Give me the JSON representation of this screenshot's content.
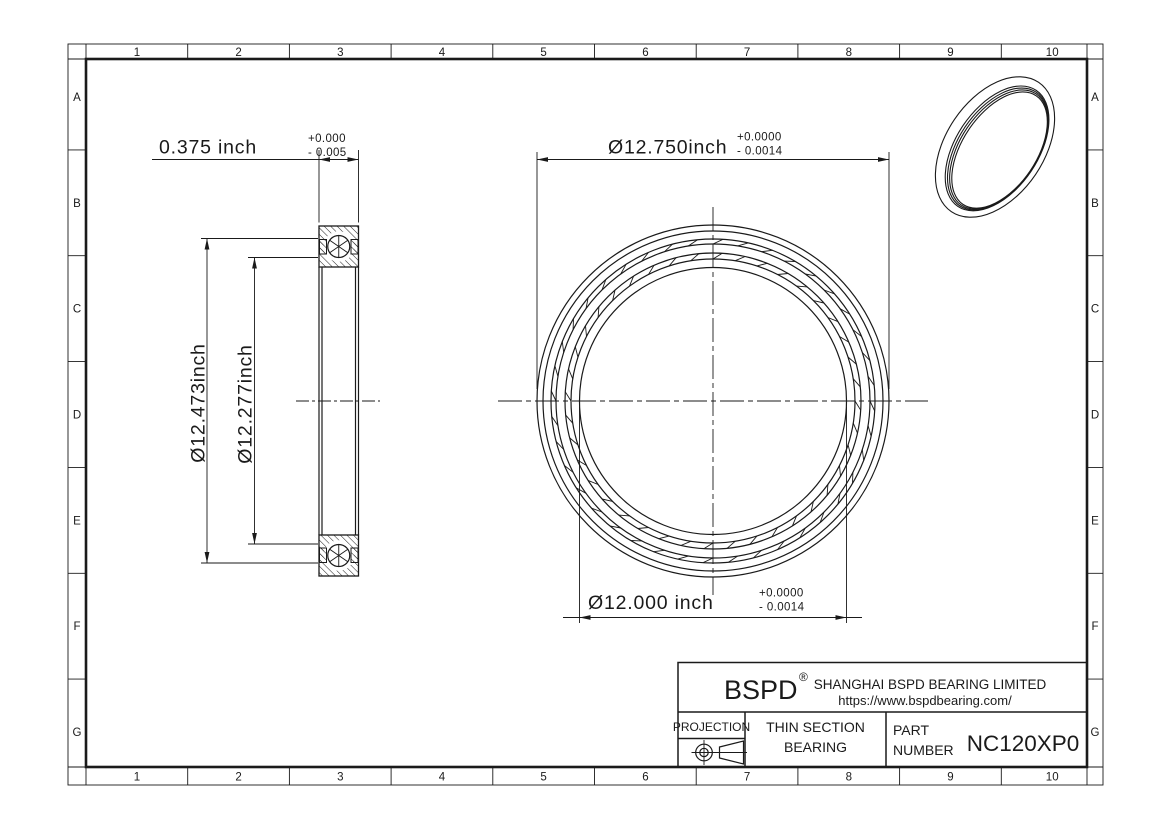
{
  "frame": {
    "columns": [
      "1",
      "2",
      "3",
      "4",
      "5",
      "6",
      "7",
      "8",
      "9",
      "10"
    ],
    "rows": [
      "A",
      "B",
      "C",
      "D",
      "E",
      "F",
      "G"
    ]
  },
  "dimensions": {
    "width": {
      "value": "0.375 inch",
      "tol_plus": "+0.000",
      "tol_minus": "- 0.005"
    },
    "outer_diameter": {
      "value": "Ø12.750inch",
      "tol_plus": "+0.0000",
      "tol_minus": "- 0.0014"
    },
    "bore_diameter": {
      "value": "Ø12.000 inch",
      "tol_plus": "+0.0000",
      "tol_minus": "- 0.0014"
    },
    "outer_race_diameter": {
      "value": "Ø12.473inch"
    },
    "inner_race_diameter": {
      "value": "Ø12.277inch"
    }
  },
  "title_block": {
    "logo": "BSPD",
    "registered_mark": "®",
    "company": "SHANGHAI BSPD BEARING LIMITED",
    "website": "https://www.bspdbearing.com/",
    "projection_label": "PROJECTION",
    "product_line1": "THIN SECTION",
    "product_line2": "BEARING",
    "part_label_line1": "PART",
    "part_label_line2": "NUMBER",
    "part_number": "NC120XP0"
  },
  "colors": {
    "line": "#1a1a1a",
    "background": "#ffffff"
  }
}
